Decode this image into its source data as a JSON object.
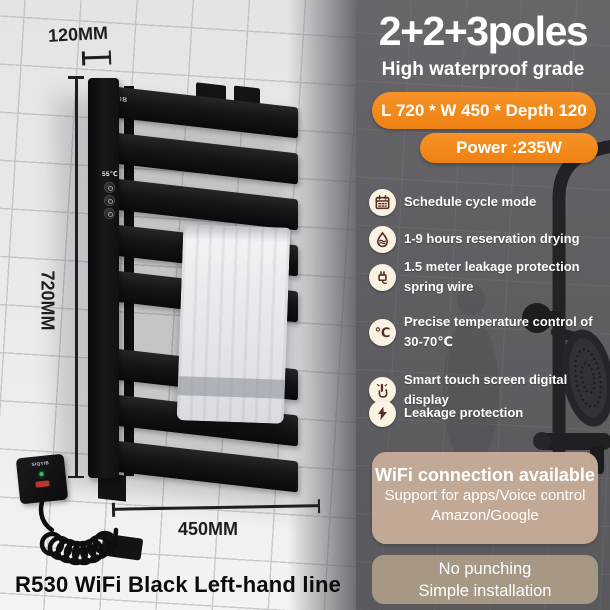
{
  "brand": "SIQYIB",
  "scene": {
    "dim_top": "120MM",
    "dim_left": "720MM",
    "dim_bottom": "450MM",
    "product_name": "R530 WiFi Black Left-hand line",
    "panel_display": "55℃"
  },
  "info": {
    "title": "2+2+3poles",
    "subtitle": "High waterproof grade",
    "badge_size": "L 720 * W 450 * Depth 120",
    "badge_power": "Power :235W",
    "features": [
      {
        "icon": "calendar-icon",
        "text": "Schedule cycle mode"
      },
      {
        "icon": "water-drop-icon",
        "text": "1-9 hours reservation drying"
      },
      {
        "icon": "plug-icon",
        "text": "1.5 meter leakage protection\nspring wire"
      },
      {
        "icon": "temperature-icon",
        "glyph": "℃",
        "text": "Precise temperature control of\n30-70℃"
      },
      {
        "icon": "touch-icon",
        "text": "Smart touch screen digital display"
      },
      {
        "icon": "lightning-icon",
        "text": "Leakage protection"
      }
    ],
    "wifi_box": {
      "title": "WiFi connection available",
      "line1": "Support for apps/Voice control",
      "line2": "Amazon/Google"
    },
    "install_box": {
      "line1": "No punching",
      "line2": "Simple installation"
    }
  },
  "colors": {
    "accent_orange": "#f28a1c",
    "panel_bg": "#5f5f63",
    "icon_bg": "#faf3e3",
    "icon_ink": "#5a2b20",
    "wifi_box_bg": "#c6ad98",
    "install_box_bg": "#b0a08a"
  }
}
